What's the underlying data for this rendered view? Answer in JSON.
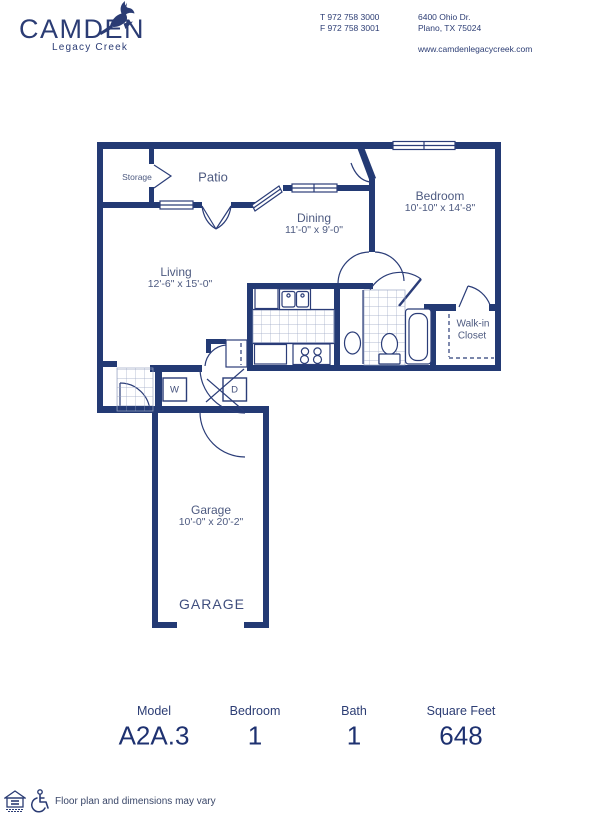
{
  "header": {
    "brand": "CAMDEN",
    "brand_sub": "Legacy Creek",
    "phone_t": "T 972 758 3000",
    "phone_f": "F 972 758 3001",
    "addr1": "6400 Ohio Dr.",
    "addr2": "Plano, TX 75024",
    "website": "www.camdenlegacycreek.com"
  },
  "plan": {
    "storage": "Storage",
    "patio": "Patio",
    "dining": "Dining",
    "dining_dims": "11'-0\" x 9'-0\"",
    "bedroom": "Bedroom",
    "bedroom_dims": "10'-10\" x 14'-8\"",
    "living": "Living",
    "living_dims": "12'-6\" x 15'-0\"",
    "walkin1": "Walk-in",
    "walkin2": "Closet",
    "washer": "W",
    "dryer": "D",
    "garage": "Garage",
    "garage_dims": "10'-0\" x 20'-2\"",
    "garage_big": "GARAGE"
  },
  "summary": {
    "columns": [
      {
        "label": "Model",
        "value": "A2A.3"
      },
      {
        "label": "Bedroom",
        "value": "1"
      },
      {
        "label": "Bath",
        "value": "1"
      },
      {
        "label": "Square Feet",
        "value": "648"
      }
    ]
  },
  "footer": {
    "disclaimer": "Floor plan and dimensions may vary"
  },
  "colors": {
    "navy": "#233a74",
    "label": "#4d5a80"
  }
}
